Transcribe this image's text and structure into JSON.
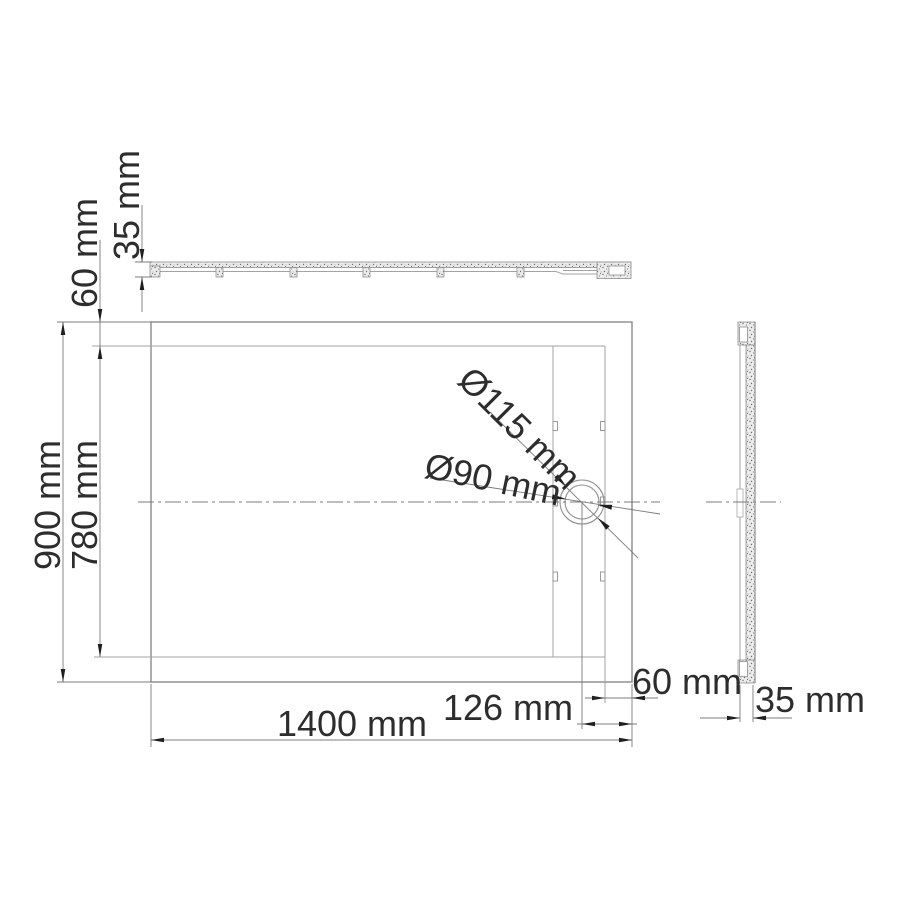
{
  "drawing": {
    "labels": {
      "top_height": "35 mm",
      "top_border": "60 mm",
      "overall_depth": "900 mm",
      "inner_depth": "780 mm",
      "drain_outer_diameter": "Ø115 mm",
      "drain_inner_diameter": "Ø90 mm",
      "right_border": "60 mm",
      "drain_offset": "126 mm",
      "overall_width": "1400 mm",
      "side_thickness": "35 mm"
    }
  }
}
